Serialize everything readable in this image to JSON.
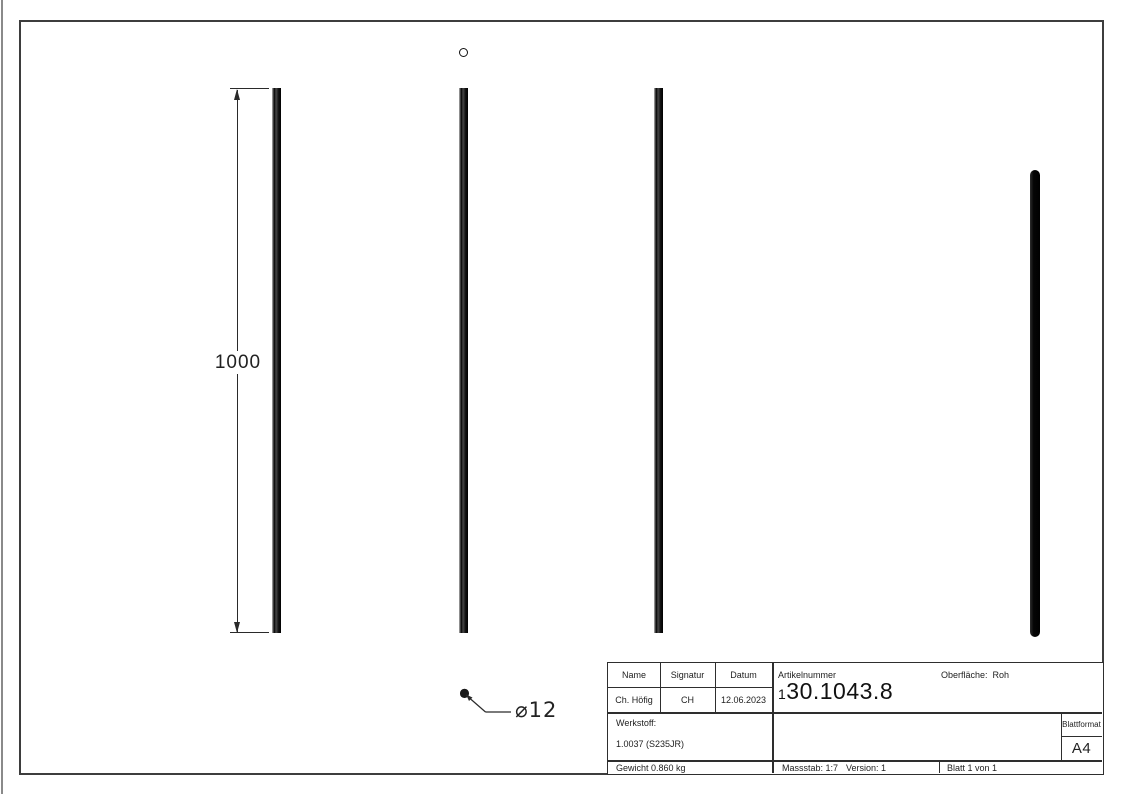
{
  "drawing": {
    "dimension_length": "1000",
    "diameter_label": "⌀12"
  },
  "title_block": {
    "name_label": "Name",
    "signatur_label": "Signatur",
    "datum_label": "Datum",
    "name_value": "Ch. Höfig",
    "signatur_value": "CH",
    "datum_value": "12.06.2023",
    "artikelnummer_label": "Artikelnummer",
    "artikelnummer_value": "130.1043.8",
    "oberflaeche_label": "Oberfläche:",
    "oberflaeche_value": "Roh",
    "werkstoff_label": "Werkstoff:",
    "werkstoff_value": "1.0037 (S235JR)",
    "gewicht_text": "Gewicht 0.860 kg",
    "massstab_text": "Massstab: 1:7",
    "version_text": "Version: 1",
    "blatt_text": "Blatt 1 von 1",
    "blattformat_label": "Blattformat",
    "blattformat_value": "A4"
  },
  "colors": {
    "line_color": "#2a2a2a",
    "frame_color": "#3d3d3d",
    "rod_color": "#0a0a0a"
  }
}
